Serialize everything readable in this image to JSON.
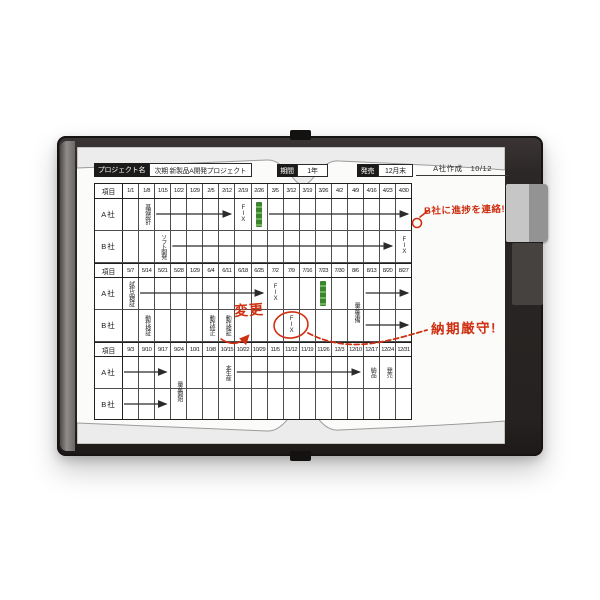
{
  "header": {
    "project_name_label": "プロジェクト名",
    "project_name": "次期 新製品A開発プロジェクト",
    "period_label": "期間",
    "period_value": "1年",
    "release_label": "発売",
    "release_value": "12月末",
    "created_by": "A社作成　10/12"
  },
  "annotations": {
    "progress_note": "B社に進捗を連絡!",
    "change_note": "変更",
    "deadline_note": "納期厳守!"
  },
  "colors": {
    "annotation_red": "#cf3012",
    "marker_green": "#3c8530",
    "frame": "#2b2726",
    "grid_line": "#4e4e4e",
    "grid_frame": "#1f1f1f"
  },
  "chart_data": {
    "type": "gantt",
    "item_header": "項目",
    "company_rows": [
      "A社",
      "B社"
    ],
    "fix_label": "FIX",
    "sections": [
      {
        "dates": [
          "1/1",
          "1/8",
          "1/15",
          "1/22",
          "1/29",
          "2/5",
          "2/12",
          "2/19",
          "2/26",
          "3/5",
          "3/12",
          "3/19",
          "3/26",
          "4/2",
          "4/9",
          "4/16",
          "4/23",
          "4/30"
        ]
      },
      {
        "dates": [
          "5/7",
          "5/14",
          "5/21",
          "5/28",
          "1/29",
          "6/4",
          "6/11",
          "6/18",
          "6/25",
          "7/2",
          "7/9",
          "7/16",
          "7/23",
          "7/30",
          "8/6",
          "8/13",
          "8/20",
          "8/27"
        ]
      },
      {
        "dates": [
          "9/3",
          "9/10",
          "9/17",
          "9/24",
          "10/1",
          "10/8",
          "10/15",
          "10/22",
          "10/29",
          "11/5",
          "11/12",
          "11/19",
          "11/26",
          "12/3",
          "12/10",
          "12/17",
          "12/24",
          "12/31"
        ]
      }
    ],
    "tasks": [
      {
        "section": 0,
        "row": "A社",
        "kind": "label",
        "col": 1,
        "text": "基礎設計"
      },
      {
        "section": 0,
        "row": "A社",
        "kind": "arrow",
        "from": 2,
        "to": 6
      },
      {
        "section": 0,
        "row": "A社",
        "kind": "fix",
        "col": 7,
        "text": "FIX"
      },
      {
        "section": 0,
        "row": "A社",
        "kind": "highlight",
        "col": 8
      },
      {
        "section": 0,
        "row": "A社",
        "kind": "arrow",
        "from": 9,
        "to": 17
      },
      {
        "section": 0,
        "row": "B社",
        "kind": "label",
        "col": 2,
        "text": "ソフト開発"
      },
      {
        "section": 0,
        "row": "B社",
        "kind": "arrow",
        "from": 3,
        "to": 16
      },
      {
        "section": 0,
        "row": "B社",
        "kind": "fix",
        "col": 17,
        "text": "FIX"
      },
      {
        "section": 1,
        "row": "A社",
        "kind": "label",
        "col": 0,
        "text": "試作品検証"
      },
      {
        "section": 1,
        "row": "A社",
        "kind": "arrow",
        "from": 1,
        "to": 8
      },
      {
        "section": 1,
        "row": "A社",
        "kind": "fix",
        "col": 9,
        "text": "FIX"
      },
      {
        "section": 1,
        "row": "A社",
        "kind": "highlight",
        "col": 12
      },
      {
        "section": 1,
        "row": "A社",
        "kind": "label",
        "col": 14,
        "text": "量産準備",
        "span": true
      },
      {
        "section": 1,
        "row": "A社",
        "kind": "arrow",
        "from": 15,
        "to": 17
      },
      {
        "section": 1,
        "row": "B社",
        "kind": "label",
        "col": 1,
        "text": "動作検証"
      },
      {
        "section": 1,
        "row": "B社",
        "kind": "label",
        "col": 5,
        "text": "動作修正"
      },
      {
        "section": 1,
        "row": "B社",
        "kind": "label",
        "col": 6,
        "text": "動作検証"
      },
      {
        "section": 1,
        "row": "B社",
        "kind": "fix",
        "col": 10,
        "text": "FIX",
        "circled": true
      },
      {
        "section": 1,
        "row": "B社",
        "kind": "arrow",
        "from": 15,
        "to": 17
      },
      {
        "section": 2,
        "row": "A社",
        "kind": "arrow",
        "from": 0,
        "to": 2
      },
      {
        "section": 2,
        "row": "A社",
        "kind": "label",
        "col": 3,
        "text": "量産開始",
        "span": true
      },
      {
        "section": 2,
        "row": "A社",
        "kind": "label",
        "col": 6,
        "text": "本生産"
      },
      {
        "section": 2,
        "row": "A社",
        "kind": "arrow",
        "from": 7,
        "to": 14
      },
      {
        "section": 2,
        "row": "A社",
        "kind": "label",
        "col": 15,
        "text": "納品"
      },
      {
        "section": 2,
        "row": "A社",
        "kind": "label",
        "col": 16,
        "text": "発売"
      },
      {
        "section": 2,
        "row": "B社",
        "kind": "arrow",
        "from": 0,
        "to": 2
      }
    ]
  }
}
